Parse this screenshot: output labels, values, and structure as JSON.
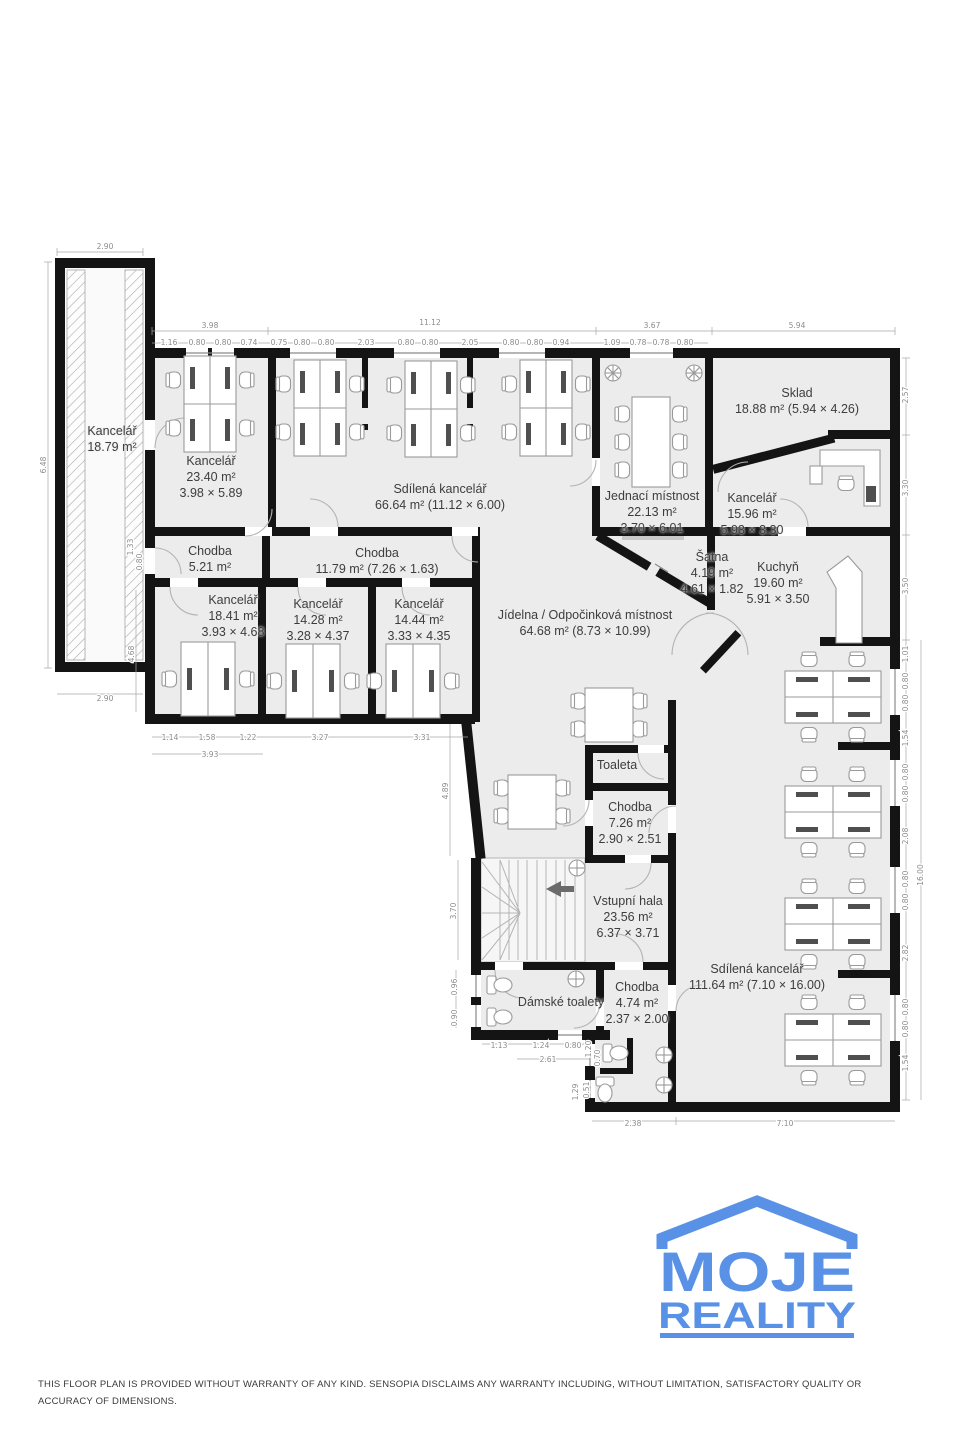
{
  "meta": {
    "disclaimer": "THIS FLOOR PLAN IS PROVIDED WITHOUT WARRANTY OF ANY KIND. SENSOPIA DISCLAIMS ANY WARRANTY INCLUDING, WITHOUT LIMITATION, SATISFACTORY QUALITY OR ACCURACY OF DIMENSIONS."
  },
  "brand": {
    "line1": "MOJE",
    "line2": "REALITY",
    "logo_color": "#5891e6"
  },
  "colors": {
    "wall": "#141414",
    "floor": "#ececec",
    "dim_text": "#8c8c8c",
    "label_text": "#3d3d3d"
  },
  "rooms": {
    "r1": {
      "name": "Kancelář",
      "area": "18.79 m²"
    },
    "r2": {
      "name": "Kancelář",
      "area": "23.40 m²",
      "size": "3.98 × 5.89"
    },
    "r3": {
      "name": "Sdílená kancelář",
      "area": "66.64 m² (11.12 × 6.00)"
    },
    "r4": {
      "name": "Jednací místnost",
      "area": "22.13 m²",
      "size": "3.70 × 6.01"
    },
    "r5": {
      "name": "Sklad",
      "area": "18.88 m² (5.94 × 4.26)"
    },
    "r6": {
      "name": "Kancelář",
      "area": "15.96 m²",
      "size": "5.93 × 3.30"
    },
    "r7": {
      "name": "Chodba",
      "area": "5.21 m²"
    },
    "r8": {
      "name": "Chodba",
      "area": "11.79 m² (7.26 × 1.63)"
    },
    "r9": {
      "name": "Kancelář",
      "area": "18.41 m²",
      "size": "3.93 × 4.68"
    },
    "r10": {
      "name": "Kancelář",
      "area": "14.28 m²",
      "size": "3.28 × 4.37"
    },
    "r11": {
      "name": "Kancelář",
      "area": "14.44 m²",
      "size": "3.33 × 4.35"
    },
    "r12": {
      "name": "Šatna",
      "area": "4.19 m²",
      "size": "4.61 × 1.82"
    },
    "r13": {
      "name": "Kuchyň",
      "area": "19.60 m²",
      "size": "5.91 × 3.50"
    },
    "r14": {
      "name": "Jídelna / Odpočinková místnost",
      "area": "64.68 m² (8.73 × 10.99)"
    },
    "r15": {
      "name": "Toaleta"
    },
    "r16": {
      "name": "Chodba",
      "area": "7.26 m²",
      "size": "2.90 × 2.51"
    },
    "r17": {
      "name": "Vstupní hala",
      "area": "23.56 m²",
      "size": "6.37 × 3.71"
    },
    "r18": {
      "name": "Dámské toalety"
    },
    "r19": {
      "name": "Chodba",
      "area": "4.74 m²",
      "size": "2.37 × 2.00"
    },
    "r20": {
      "name": "Sdílená kancelář",
      "area": "111.64 m² (7.10 × 16.00)"
    }
  },
  "dims": {
    "annex_top": "2.90",
    "top": [
      "3.98",
      "11.12",
      "3.67",
      "5.94"
    ],
    "top_sub": [
      "1.16",
      "0.80",
      "0.80",
      "0.74",
      "0.75",
      "0.80",
      "0.80",
      "2.03",
      "0.80",
      "0.80",
      "2.05",
      "0.80",
      "0.80",
      "0.94",
      "1.09",
      "0.78",
      "0.78",
      "0.80"
    ],
    "left": [
      "6.48",
      "2.90",
      "1.33",
      "0.80",
      "4.68"
    ],
    "bottom_left": [
      "1.14",
      "1.58",
      "1.22",
      "3.93",
      "3.27",
      "3.31"
    ],
    "right": [
      "2.57",
      "3.30",
      "3.50",
      "1.01",
      "0.80",
      "0.80",
      "1.54",
      "0.80",
      "0.80",
      "2.08",
      "0.80",
      "0.80",
      "2.82",
      "0.80",
      "0.80",
      "1.54"
    ],
    "right_total": "16.00",
    "bottom": [
      "2.38",
      "7.10"
    ],
    "misc": [
      "3.70",
      "4.89",
      "2.61",
      "1.13",
      "1.24",
      "0.80",
      "1.20",
      "0.70",
      "1.29",
      "0.51",
      "0.96",
      "0.90"
    ]
  }
}
